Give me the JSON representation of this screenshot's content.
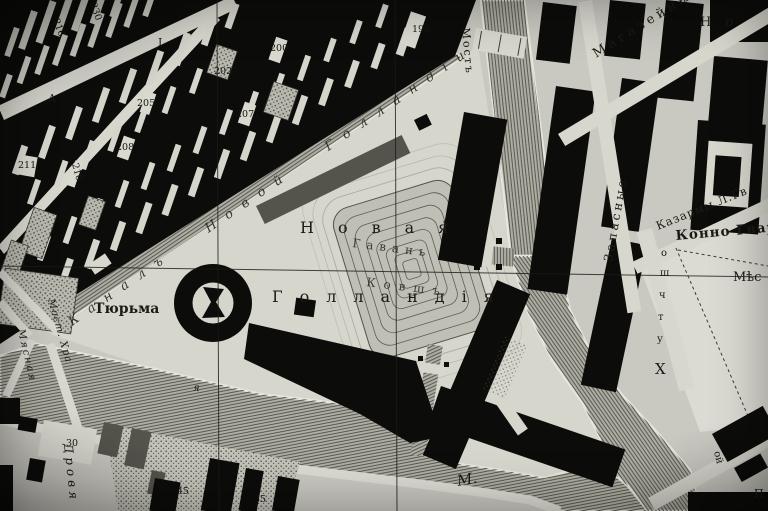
{
  "map": {
    "labels": {
      "canal_name": "Каналъ Новой Голландіи",
      "island_word1": "Новая",
      "island_word2": "Голландія",
      "basin_upper": "Гавань",
      "basin_lower": "Ковшъ",
      "prison": "Тюрьма",
      "bridge": "Мостъ",
      "magazines": "Магазейны",
      "zapasnye": "Запасные",
      "kazarmy": "Казармы Л.Гв.",
      "konno_gvard": "Конно Гвар",
      "mesto_fragment": "Мѣс",
      "no_fragment": "Но",
      "moika_initial": "М.",
      "letter_ya": "я",
      "drovyanoy": "Дровя",
      "myasnaya": "Мясная",
      "most_khra": "Мост. Хра",
      "se_street_fragment": "ой",
      "se_letter_p": "П",
      "block_letter_a": "А",
      "block_letter_i": "І",
      "east_letters": [
        "о",
        "ш",
        "ч",
        "т",
        "у",
        "Х"
      ]
    },
    "numbers": {
      "n230": "230",
      "n216": "216",
      "n196": "196",
      "n200": "200",
      "n202": "202",
      "n205": "205",
      "n207": "207",
      "n208": "208",
      "n211": "211",
      "n210": "210",
      "n30": "30",
      "n45": "45",
      "n35": "35"
    },
    "colors": {
      "paper": "#c9c8c1",
      "paper_light": "#d8d7ce",
      "building_ink": "#0c0c0a",
      "water_base": "#aeada3",
      "water_line": "#55544b",
      "label_ink": "#1b1b15"
    }
  }
}
